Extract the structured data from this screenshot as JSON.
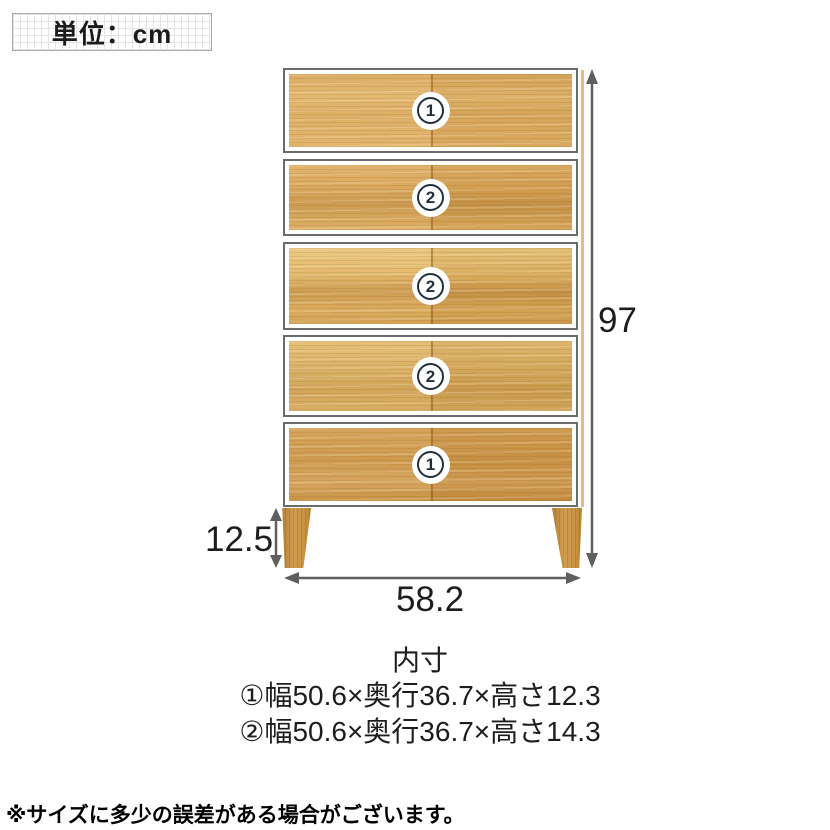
{
  "unit_box": {
    "label": "単位：cm"
  },
  "chest": {
    "drawers": [
      {
        "number": "1"
      },
      {
        "number": "2"
      },
      {
        "number": "2"
      },
      {
        "number": "2"
      },
      {
        "number": "1"
      }
    ]
  },
  "dimensions": {
    "total_height": "97",
    "leg_height": "12.5",
    "width": "58.2"
  },
  "inner_size": {
    "title": "内寸",
    "line1": "①幅50.6×奥行36.7×高さ12.3",
    "line2": "②幅50.6×奥行36.7×高さ14.3"
  },
  "footnote": "※サイズに多少の誤差がある場合がございます。",
  "colors": {
    "wood_base": "#d9a75c",
    "wood_dark": "#c9964a",
    "arrow": "#5f5f5f",
    "badge_ring": "#20303f",
    "grid_line": "#e4e4e4",
    "border_gray": "#6b6b6b"
  }
}
